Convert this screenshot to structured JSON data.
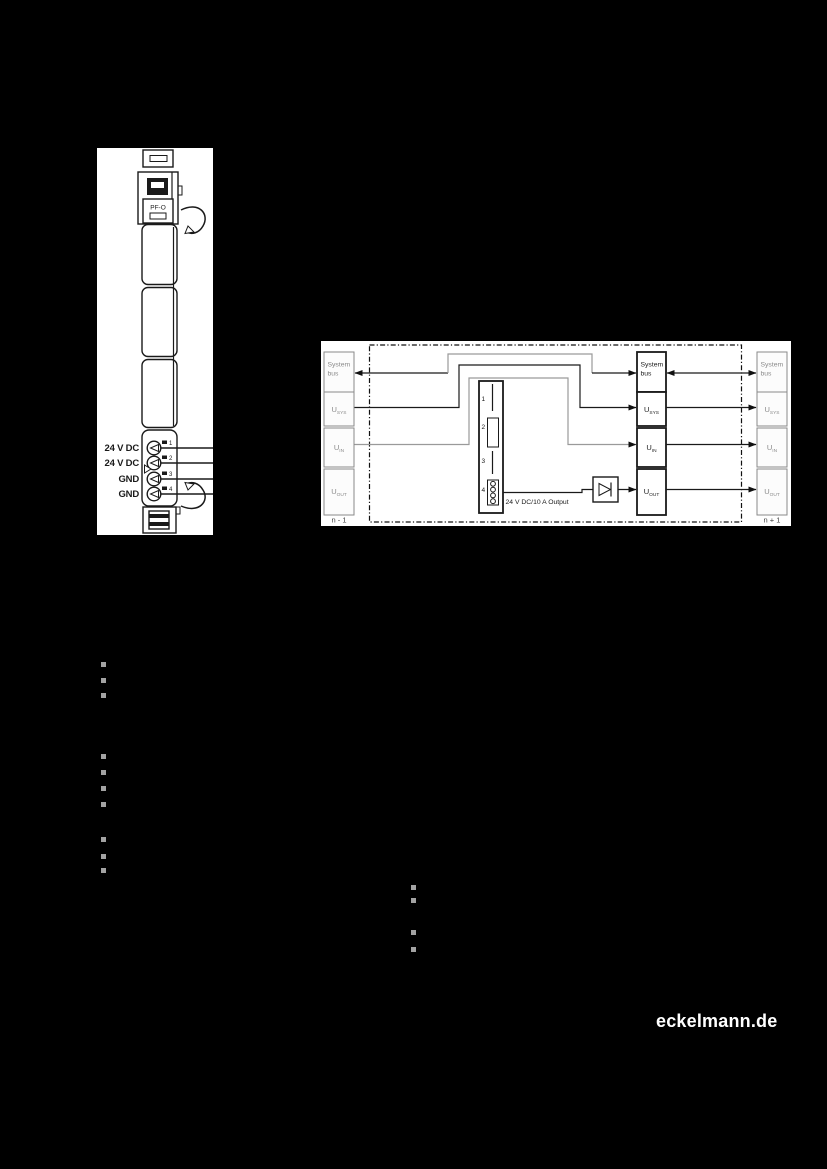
{
  "figures": {
    "module": {
      "label_plate": "PF-O",
      "terminals": [
        {
          "num": "1",
          "label": "24 V DC"
        },
        {
          "num": "2",
          "label": "24 V DC"
        },
        {
          "num": "3",
          "label": "GND"
        },
        {
          "num": "4",
          "label": "GND"
        }
      ]
    },
    "diagram": {
      "prev_caption": "n - 1",
      "next_caption": "n + 1",
      "pins": [
        "1",
        "2",
        "3",
        "4"
      ],
      "output_label": "24 V DC/10 A Output",
      "block": {
        "system_line1": "System",
        "system_line2": "bus",
        "u": "U",
        "sys": "SYS",
        "in": "IN",
        "out": "OUT"
      }
    }
  },
  "footer": {
    "brand": "eckelmann.de"
  },
  "colors": {
    "page_bg": "#000000",
    "canvas": "#ffffff",
    "ink": "#1a1a1a",
    "muted": "#8a8a8a",
    "line_gray": "#9a9a9a",
    "bullet": "#a3a3a3",
    "brand": "#ffffff"
  }
}
